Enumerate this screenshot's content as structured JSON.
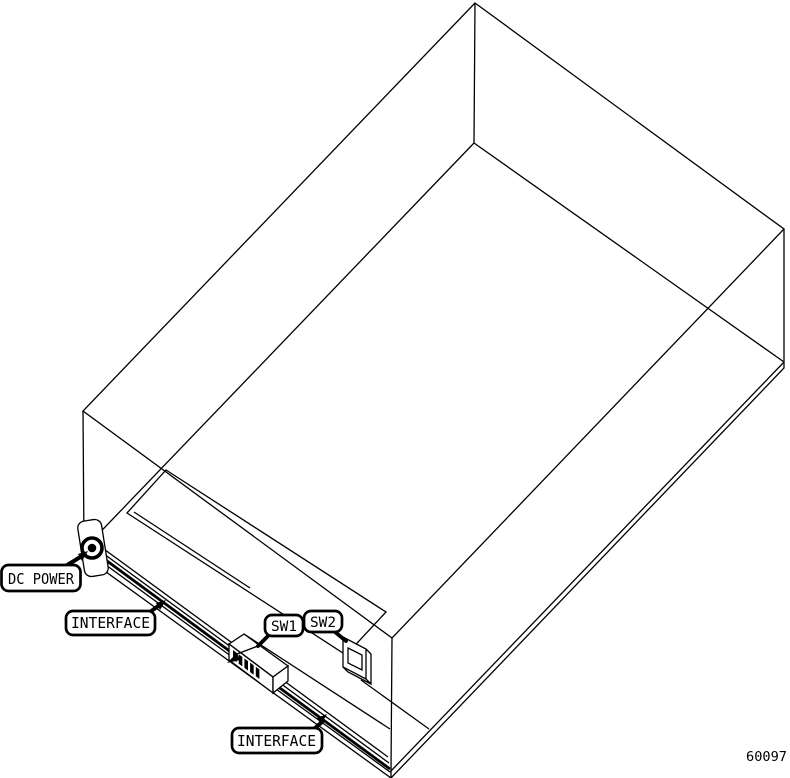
{
  "figure": {
    "number": "60097",
    "labels": {
      "dc_power": "DC POWER",
      "interface_top": "INTERFACE",
      "sw1": "SW1",
      "sw2": "SW2",
      "interface_bottom": "INTERFACE"
    },
    "colors": {
      "line": "#000000",
      "background": "#ffffff"
    }
  }
}
